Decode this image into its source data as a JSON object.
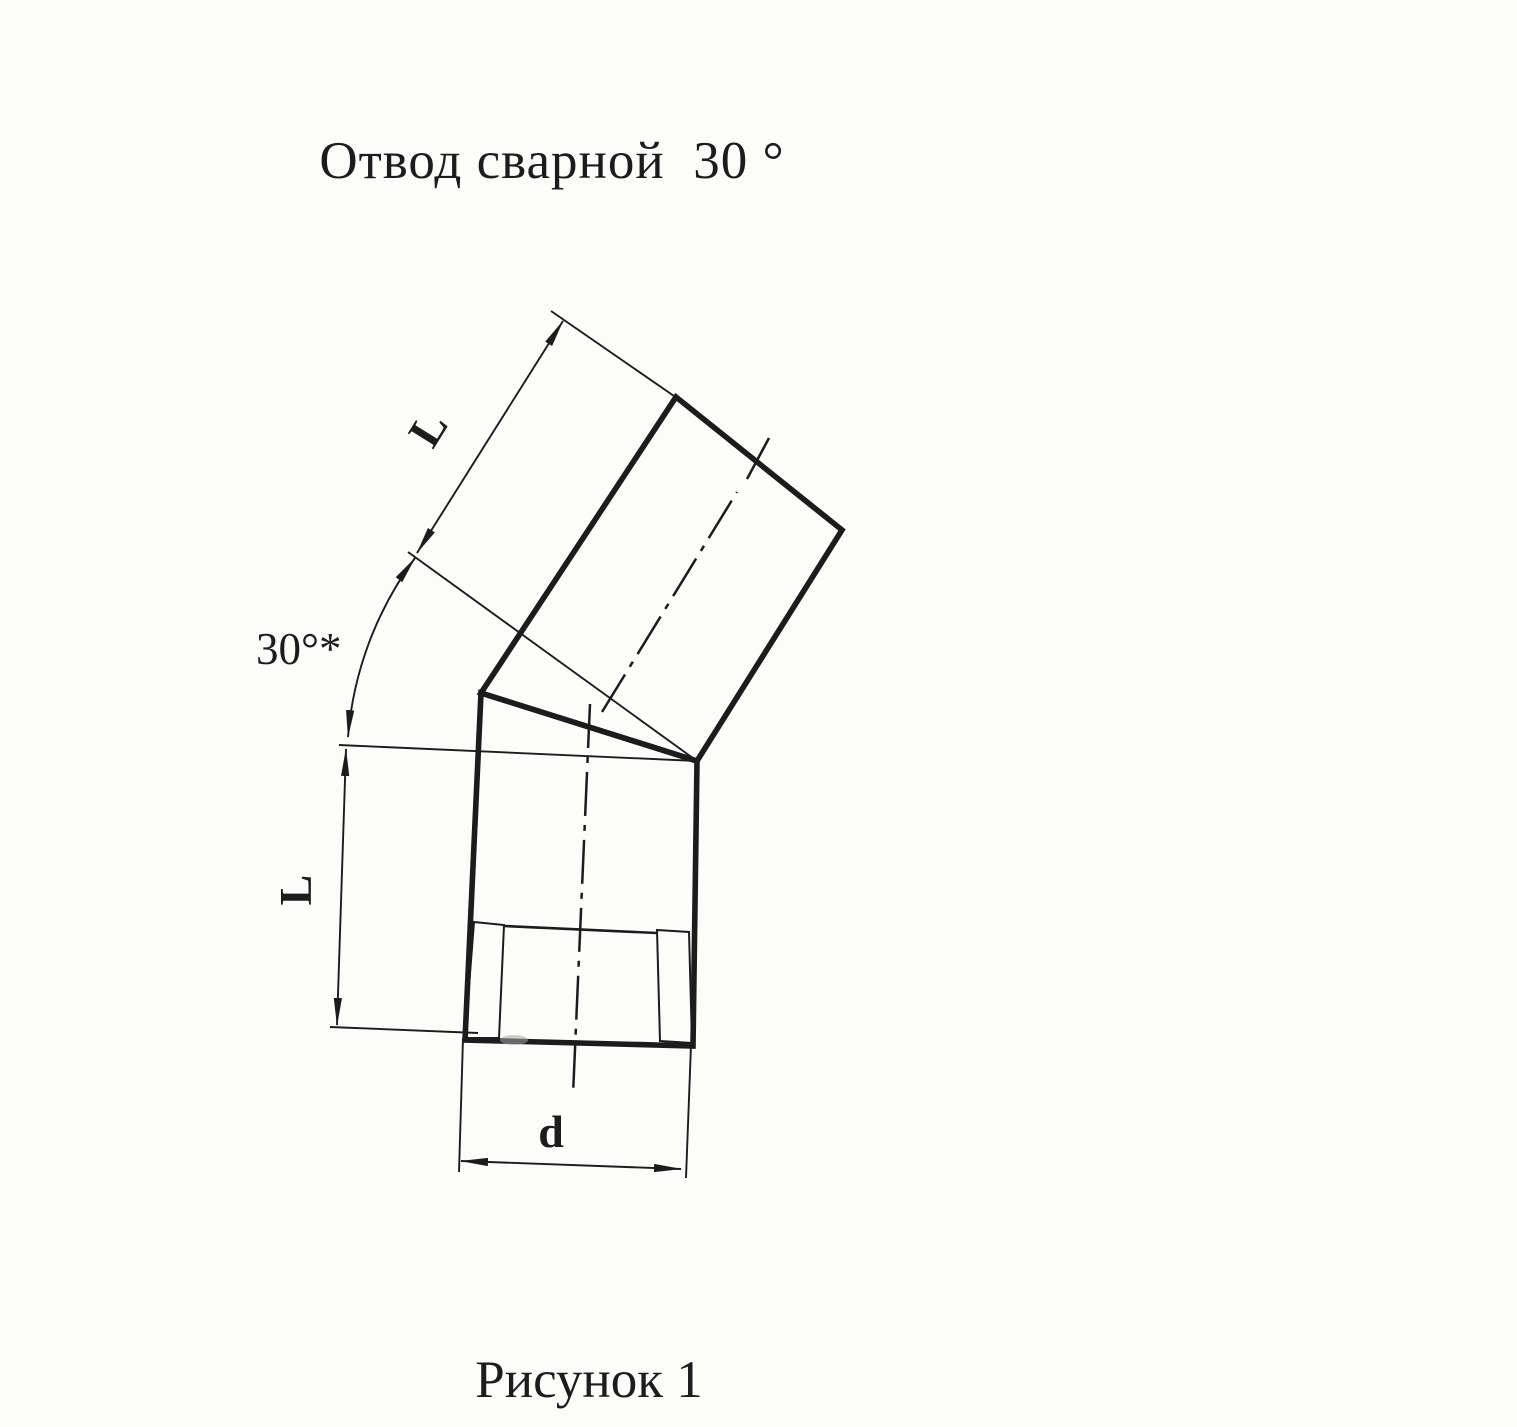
{
  "colors": {
    "ink": "#1c1c1c",
    "paper": "#fcfcfb"
  },
  "title": "Отвод сварной  30 °",
  "caption": "Рисунок 1",
  "labels": {
    "upper_length": "L",
    "angle": "30°*",
    "lower_length": "L",
    "diameter": "d"
  }
}
